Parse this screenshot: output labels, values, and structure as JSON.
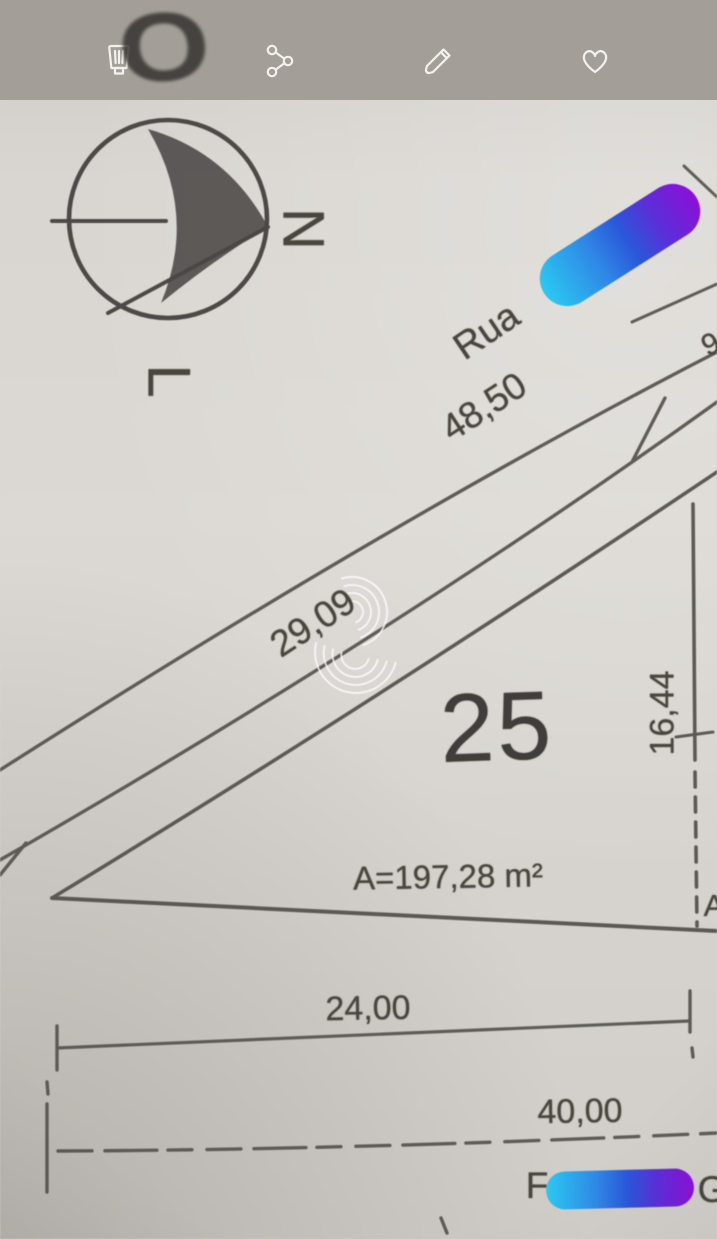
{
  "toolbar": {
    "icons": [
      "delete",
      "share",
      "edit",
      "favorite"
    ]
  },
  "plan": {
    "compass": {
      "o": "O",
      "n": "N",
      "l": "L"
    },
    "street": {
      "prefix": "Rua"
    },
    "dimensions": {
      "street_length": "48,50",
      "frontage": "29,09",
      "side_right": "16,44",
      "base": "24,00",
      "block_base": "40,00"
    },
    "lot": {
      "number": "25",
      "area_label": "A=197,28 m²"
    },
    "partial_text": {
      "bottom_left": "F",
      "bottom_right": "G",
      "right_edge": "A",
      "top_right": "9"
    }
  },
  "annotation": {
    "marker_gradient": {
      "from": "#2bc9f2",
      "mid": "#2a57da",
      "to": "#8c10d8"
    },
    "toolbar_bg": "#a39f98",
    "paper_bg": "#d9d6d1",
    "ink": "#55524d"
  }
}
